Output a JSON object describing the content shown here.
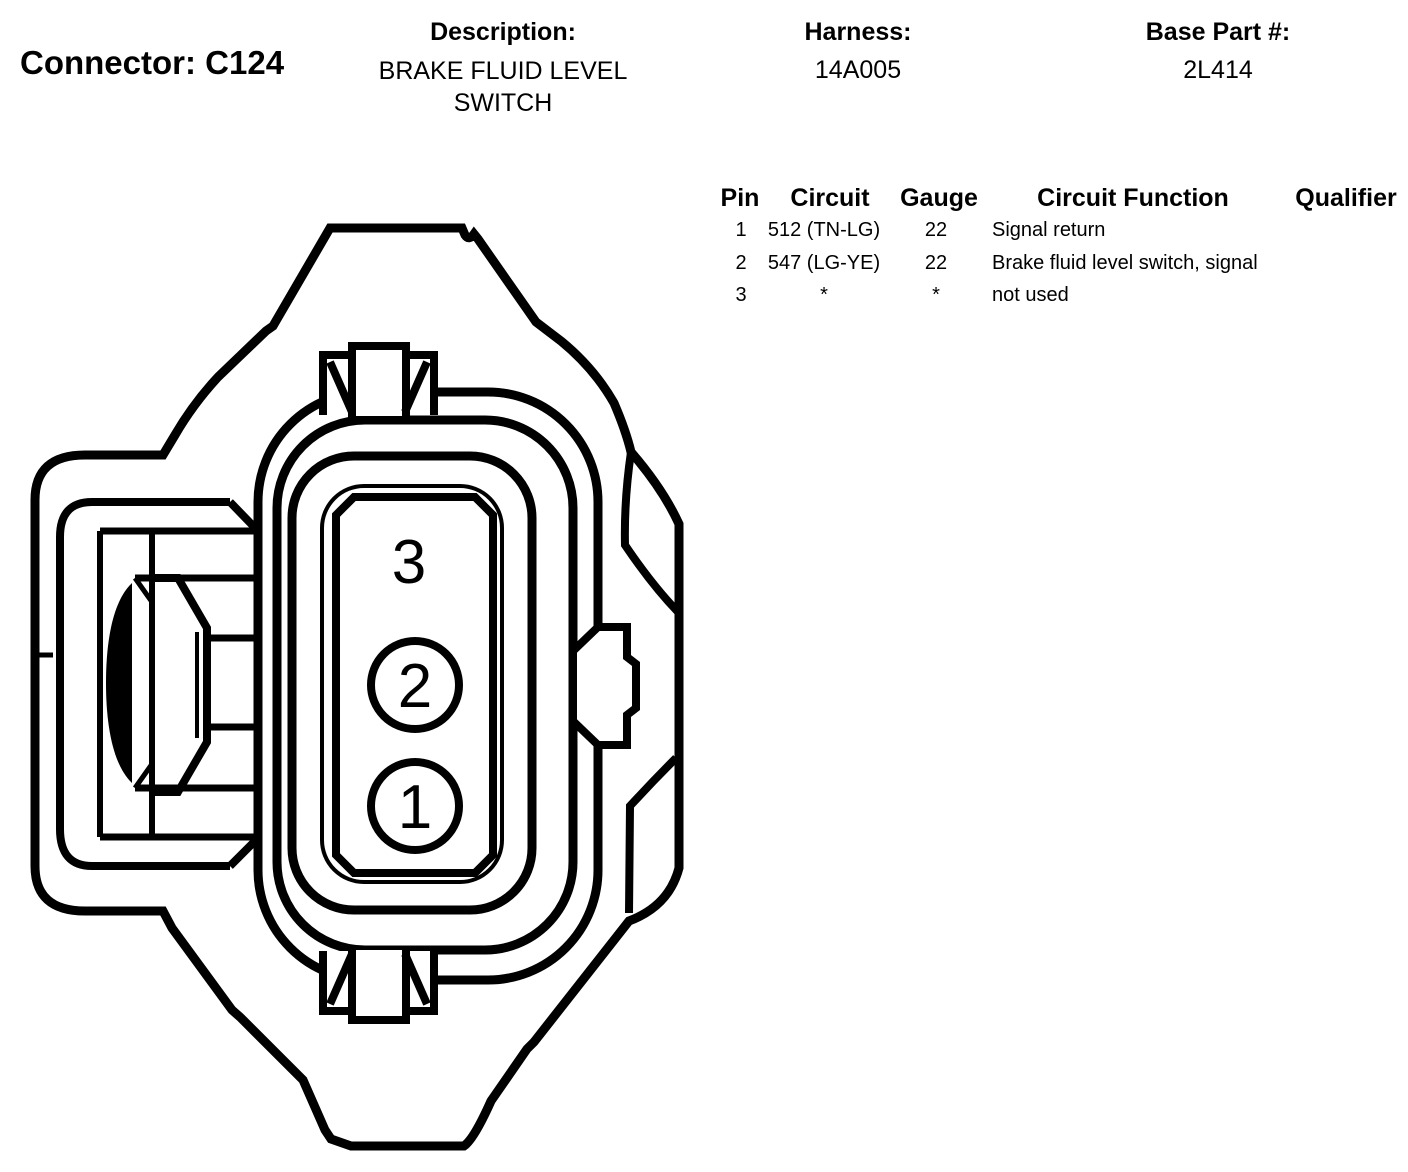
{
  "header": {
    "connector_label": "Connector: C124",
    "description_label": "Description:",
    "description_value": "BRAKE FLUID LEVEL SWITCH",
    "harness_label": "Harness:",
    "harness_value": "14A005",
    "base_part_label": "Base Part #:",
    "base_part_value": "2L414"
  },
  "pin_table": {
    "columns": [
      "Pin",
      "Circuit",
      "Gauge",
      "Circuit Function",
      "Qualifier"
    ],
    "rows": [
      {
        "pin": "1",
        "circuit": "512 (TN-LG)",
        "gauge": "22",
        "function": "Signal return",
        "qualifier": ""
      },
      {
        "pin": "2",
        "circuit": "547 (LG-YE)",
        "gauge": "22",
        "function": "Brake fluid level switch, signal",
        "qualifier": ""
      },
      {
        "pin": "3",
        "circuit": "*",
        "gauge": "*",
        "function": "not used",
        "qualifier": ""
      }
    ]
  },
  "diagram": {
    "pins": [
      {
        "label": "3"
      },
      {
        "label": "2"
      },
      {
        "label": "1"
      }
    ],
    "line_color": "#000000",
    "background": "#ffffff"
  }
}
